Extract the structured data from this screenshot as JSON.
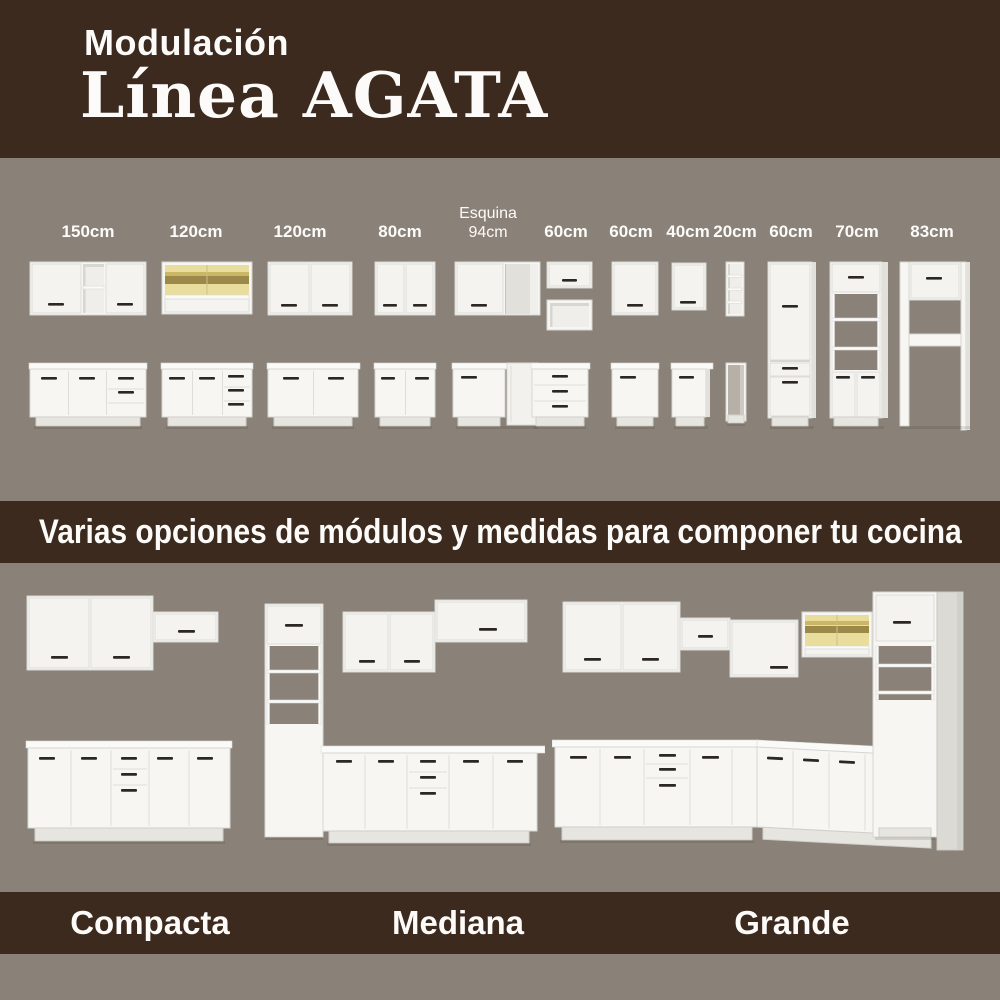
{
  "header": {
    "kicker": "Modulación",
    "title": "Línea AGATA"
  },
  "modules_section": {
    "columns": [
      {
        "label": "150cm",
        "top": "wall-2door-open-shelf",
        "bottom": "base-2door-2drawer"
      },
      {
        "label": "120cm",
        "top": "wall-glass-wood",
        "bottom": "base-2door-3drawer"
      },
      {
        "label": "120cm",
        "top": "wall-2door",
        "bottom": "base-2door"
      },
      {
        "label": "80cm",
        "top": "wall-2door",
        "bottom": "base-2door"
      },
      {
        "label": "Esquina 94cm",
        "top": "wall-corner",
        "bottom": "base-corner"
      },
      {
        "label": "60cm",
        "top": "wall-flap-plus-open-box",
        "bottom": "base-3drawer"
      },
      {
        "label": "60cm",
        "top": "wall-1door",
        "bottom": "base-1door"
      },
      {
        "label": "40cm",
        "top": "wall-1door",
        "bottom": "base-1door"
      },
      {
        "label": "20cm",
        "top": "wall-open-shelves",
        "bottom": "base-open-niche"
      },
      {
        "label": "60cm",
        "tall": "tall-pantry-2door-1drawer"
      },
      {
        "label": "70cm",
        "tall": "tall-oven-tower-open-shelves"
      },
      {
        "label": "83cm",
        "tall": "tall-fridge-surround"
      }
    ]
  },
  "banner": {
    "text": "Varias opciones de módulos y medidas para componer tu cocina"
  },
  "kitchens": {
    "items": [
      {
        "label": "Compacta"
      },
      {
        "label": "Mediana"
      },
      {
        "label": "Grande"
      }
    ]
  },
  "colors": {
    "brown": "#3B2A1D",
    "taupe": "#8A8178",
    "white_text": "#FCFBF9",
    "cabinet_white": "#F7F6F3",
    "accent_wood_glass": "#E9DD9E",
    "handle_dark": "#2B2722"
  }
}
